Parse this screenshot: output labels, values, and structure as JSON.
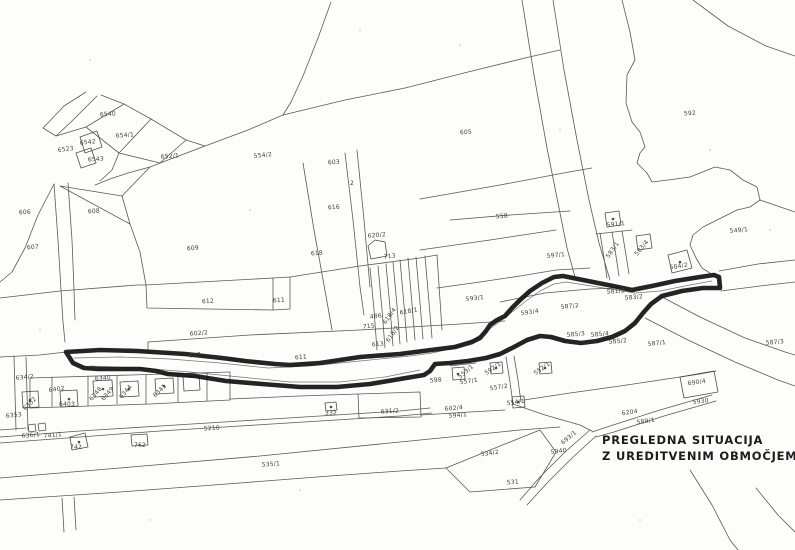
{
  "map": {
    "title_line1": "PREGLEDNA SITUACIJA",
    "title_line2": "Z UREDITVENIM OBMOČJEM",
    "paper_color": "#fdfdfc",
    "ink_color": "#3c3c3c",
    "outline_color": "#111111",
    "labels": [
      {
        "t": "6540",
        "x": 108,
        "y": 116,
        "r": -4
      },
      {
        "t": "654/1",
        "x": 125,
        "y": 137,
        "r": -4
      },
      {
        "t": "6542",
        "x": 88,
        "y": 144,
        "r": -6
      },
      {
        "t": "6543",
        "x": 96,
        "y": 161,
        "r": -4
      },
      {
        "t": "6523",
        "x": 66,
        "y": 151,
        "r": -8
      },
      {
        "t": "652/1",
        "x": 170,
        "y": 158,
        "r": -4
      },
      {
        "t": "606",
        "x": 25,
        "y": 214,
        "r": -4
      },
      {
        "t": "608",
        "x": 94,
        "y": 213,
        "r": -4
      },
      {
        "t": "607",
        "x": 33,
        "y": 249,
        "r": -4
      },
      {
        "t": "609",
        "x": 193,
        "y": 250,
        "r": -4
      },
      {
        "t": "554/2",
        "x": 263,
        "y": 157,
        "r": -6
      },
      {
        "t": "603",
        "x": 334,
        "y": 164,
        "r": -4
      },
      {
        "t": "605",
        "x": 466,
        "y": 134,
        "r": -4
      },
      {
        "t": "2",
        "x": 352,
        "y": 185,
        "r": 0
      },
      {
        "t": "616",
        "x": 334,
        "y": 209,
        "r": -4
      },
      {
        "t": "618",
        "x": 317,
        "y": 255,
        "r": -4
      },
      {
        "t": "620/2",
        "x": 377,
        "y": 237,
        "r": -5
      },
      {
        "t": "713",
        "x": 390,
        "y": 258,
        "r": -8
      },
      {
        "t": "592",
        "x": 690,
        "y": 115,
        "r": -3
      },
      {
        "t": "558",
        "x": 502,
        "y": 218,
        "r": -4
      },
      {
        "t": "591/1",
        "x": 616,
        "y": 226,
        "r": -6
      },
      {
        "t": "549/1",
        "x": 739,
        "y": 232,
        "r": -5
      },
      {
        "t": "597/1",
        "x": 556,
        "y": 257,
        "r": -5
      },
      {
        "t": "583/1",
        "x": 614,
        "y": 251,
        "r": -55
      },
      {
        "t": "583/4",
        "x": 643,
        "y": 249,
        "r": -50
      },
      {
        "t": "584/2",
        "x": 679,
        "y": 268,
        "r": -8
      },
      {
        "t": "593/1",
        "x": 475,
        "y": 300,
        "r": -6
      },
      {
        "t": "593/4",
        "x": 530,
        "y": 314,
        "r": -8
      },
      {
        "t": "581/2",
        "x": 616,
        "y": 293,
        "r": -5
      },
      {
        "t": "583/2",
        "x": 634,
        "y": 299,
        "r": -5
      },
      {
        "t": "587/2",
        "x": 570,
        "y": 308,
        "r": -6
      },
      {
        "t": "585/3",
        "x": 576,
        "y": 336,
        "r": -5
      },
      {
        "t": "585/4",
        "x": 600,
        "y": 336,
        "r": -5
      },
      {
        "t": "585/2",
        "x": 618,
        "y": 343,
        "r": -5
      },
      {
        "t": "587/1",
        "x": 657,
        "y": 345,
        "r": -6
      },
      {
        "t": "587/3",
        "x": 775,
        "y": 344,
        "r": -5
      },
      {
        "t": "612",
        "x": 208,
        "y": 303,
        "r": -3
      },
      {
        "t": "611",
        "x": 279,
        "y": 302,
        "r": -3
      },
      {
        "t": "602/2",
        "x": 199,
        "y": 335,
        "r": -4
      },
      {
        "t": "617",
        "x": 195,
        "y": 357,
        "r": -4
      },
      {
        "t": "611",
        "x": 301,
        "y": 359,
        "r": -3
      },
      {
        "t": "486",
        "x": 376,
        "y": 318,
        "r": -6
      },
      {
        "t": "618/4",
        "x": 391,
        "y": 317,
        "r": -55
      },
      {
        "t": "618/1",
        "x": 409,
        "y": 313,
        "r": -10
      },
      {
        "t": "715",
        "x": 369,
        "y": 328,
        "r": -5
      },
      {
        "t": "618/2",
        "x": 394,
        "y": 335,
        "r": -55
      },
      {
        "t": "613",
        "x": 378,
        "y": 346,
        "r": -5
      },
      {
        "t": "598",
        "x": 436,
        "y": 382,
        "r": -5
      },
      {
        "t": "602/4",
        "x": 454,
        "y": 410,
        "r": -5
      },
      {
        "t": "594/1",
        "x": 458,
        "y": 417,
        "r": -5
      },
      {
        "t": "553/1",
        "x": 467,
        "y": 373,
        "r": -40
      },
      {
        "t": "557/1",
        "x": 469,
        "y": 383,
        "r": -8
      },
      {
        "t": "592/1",
        "x": 494,
        "y": 370,
        "r": -35
      },
      {
        "t": "557/2",
        "x": 499,
        "y": 389,
        "r": -8
      },
      {
        "t": "554/1",
        "x": 516,
        "y": 404,
        "r": -8
      },
      {
        "t": "552/1",
        "x": 543,
        "y": 370,
        "r": -35
      },
      {
        "t": "534/2",
        "x": 490,
        "y": 455,
        "r": -8
      },
      {
        "t": "531",
        "x": 513,
        "y": 484,
        "r": -4
      },
      {
        "t": "693/1",
        "x": 570,
        "y": 439,
        "r": -40
      },
      {
        "t": "5940",
        "x": 559,
        "y": 453,
        "r": -8
      },
      {
        "t": "5930",
        "x": 701,
        "y": 403,
        "r": -8
      },
      {
        "t": "690/4",
        "x": 697,
        "y": 384,
        "r": -8
      },
      {
        "t": "6204",
        "x": 630,
        "y": 414,
        "r": -8
      },
      {
        "t": "589/1",
        "x": 646,
        "y": 423,
        "r": -8
      },
      {
        "t": "5210",
        "x": 212,
        "y": 430,
        "r": -4
      },
      {
        "t": "535/1",
        "x": 271,
        "y": 466,
        "r": -4
      },
      {
        "t": "332",
        "x": 331,
        "y": 415,
        "r": 0
      },
      {
        "t": "631/2",
        "x": 390,
        "y": 413,
        "r": -3
      },
      {
        "t": "6340",
        "x": 103,
        "y": 380,
        "r": -4
      },
      {
        "t": "6348",
        "x": 97,
        "y": 395,
        "r": -50
      },
      {
        "t": "6349",
        "x": 109,
        "y": 395,
        "r": -50
      },
      {
        "t": "6344",
        "x": 127,
        "y": 393,
        "r": -50
      },
      {
        "t": "6341",
        "x": 161,
        "y": 392,
        "r": -45
      },
      {
        "t": "6402",
        "x": 57,
        "y": 391,
        "r": -8
      },
      {
        "t": "6403",
        "x": 67,
        "y": 406,
        "r": 0
      },
      {
        "t": "6352",
        "x": 31,
        "y": 405,
        "r": -45
      },
      {
        "t": "634/2",
        "x": 25,
        "y": 379,
        "r": -6
      },
      {
        "t": "6353",
        "x": 14,
        "y": 417,
        "r": -6
      },
      {
        "t": "636/1",
        "x": 31,
        "y": 437,
        "r": -5
      },
      {
        "t": "741/1",
        "x": 53,
        "y": 437,
        "r": -5
      },
      {
        "t": "742",
        "x": 76,
        "y": 449,
        "r": 0
      },
      {
        "t": "762",
        "x": 140,
        "y": 447,
        "r": 0
      }
    ]
  }
}
